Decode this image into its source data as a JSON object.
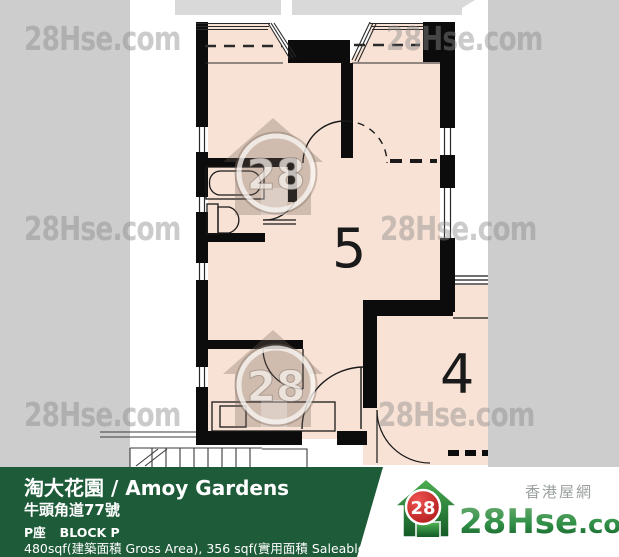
{
  "watermark": {
    "text": "28Hse.com",
    "house_badge": "28"
  },
  "plan": {
    "room5_label": "5",
    "room4_label": "4"
  },
  "footer": {
    "title": "淘大花園 / Amoy Gardens",
    "address": "牛頭角道77號",
    "block_zh": "P座",
    "block_en": "BLOCK P",
    "area_info": "480sqf(建築面積 Gross Area), 356 sqf(實用面積 Saleable Area)"
  },
  "logo": {
    "badge": "28",
    "brand": "28Hse",
    "brand_suffix": ".com",
    "tagline": "香港屋網"
  },
  "colors": {
    "page_background": "#cdcdcd",
    "floor_fill": "#f8e2d5",
    "wall": "#0c0c0c",
    "footer_green": "#1e5b39",
    "logo_red": "#c8201f",
    "logo_green": "#2f8f46",
    "watermark_gray": "#8c8c8c"
  }
}
